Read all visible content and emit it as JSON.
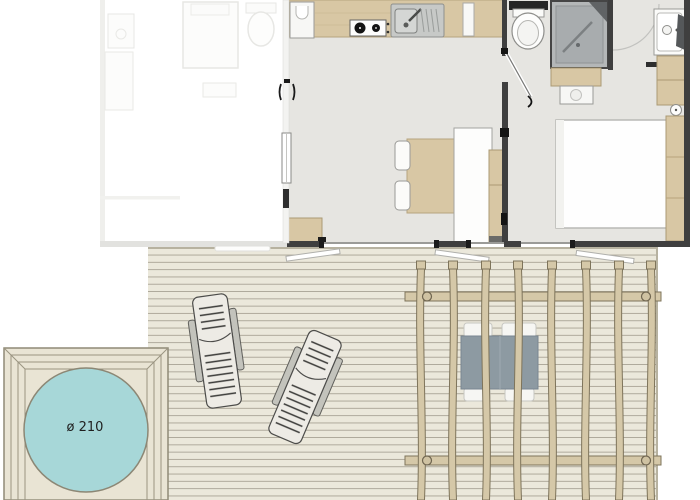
{
  "hot_tub": {
    "label": "ø 210"
  },
  "colors": {
    "water": "#a7d7d8",
    "water_edge": "#8c8775",
    "deck": "#ebe8db",
    "deck_line": "#a9a496",
    "platform": "#e9e4d4",
    "platform_line": "#97927e",
    "unit_floor": "#e6e5e1",
    "wall": "#3f3f3f",
    "wood": "#d8c7a4",
    "wood_edge": "#ab9a75",
    "pergola_wood": "#d5c8a8",
    "pergola_edge": "#7e745b",
    "outdoor_table": "#8d9aa2",
    "shower": "#b4b7b8",
    "fixture_white": "#fbfbf9",
    "lounger_body": "#edebe5"
  }
}
